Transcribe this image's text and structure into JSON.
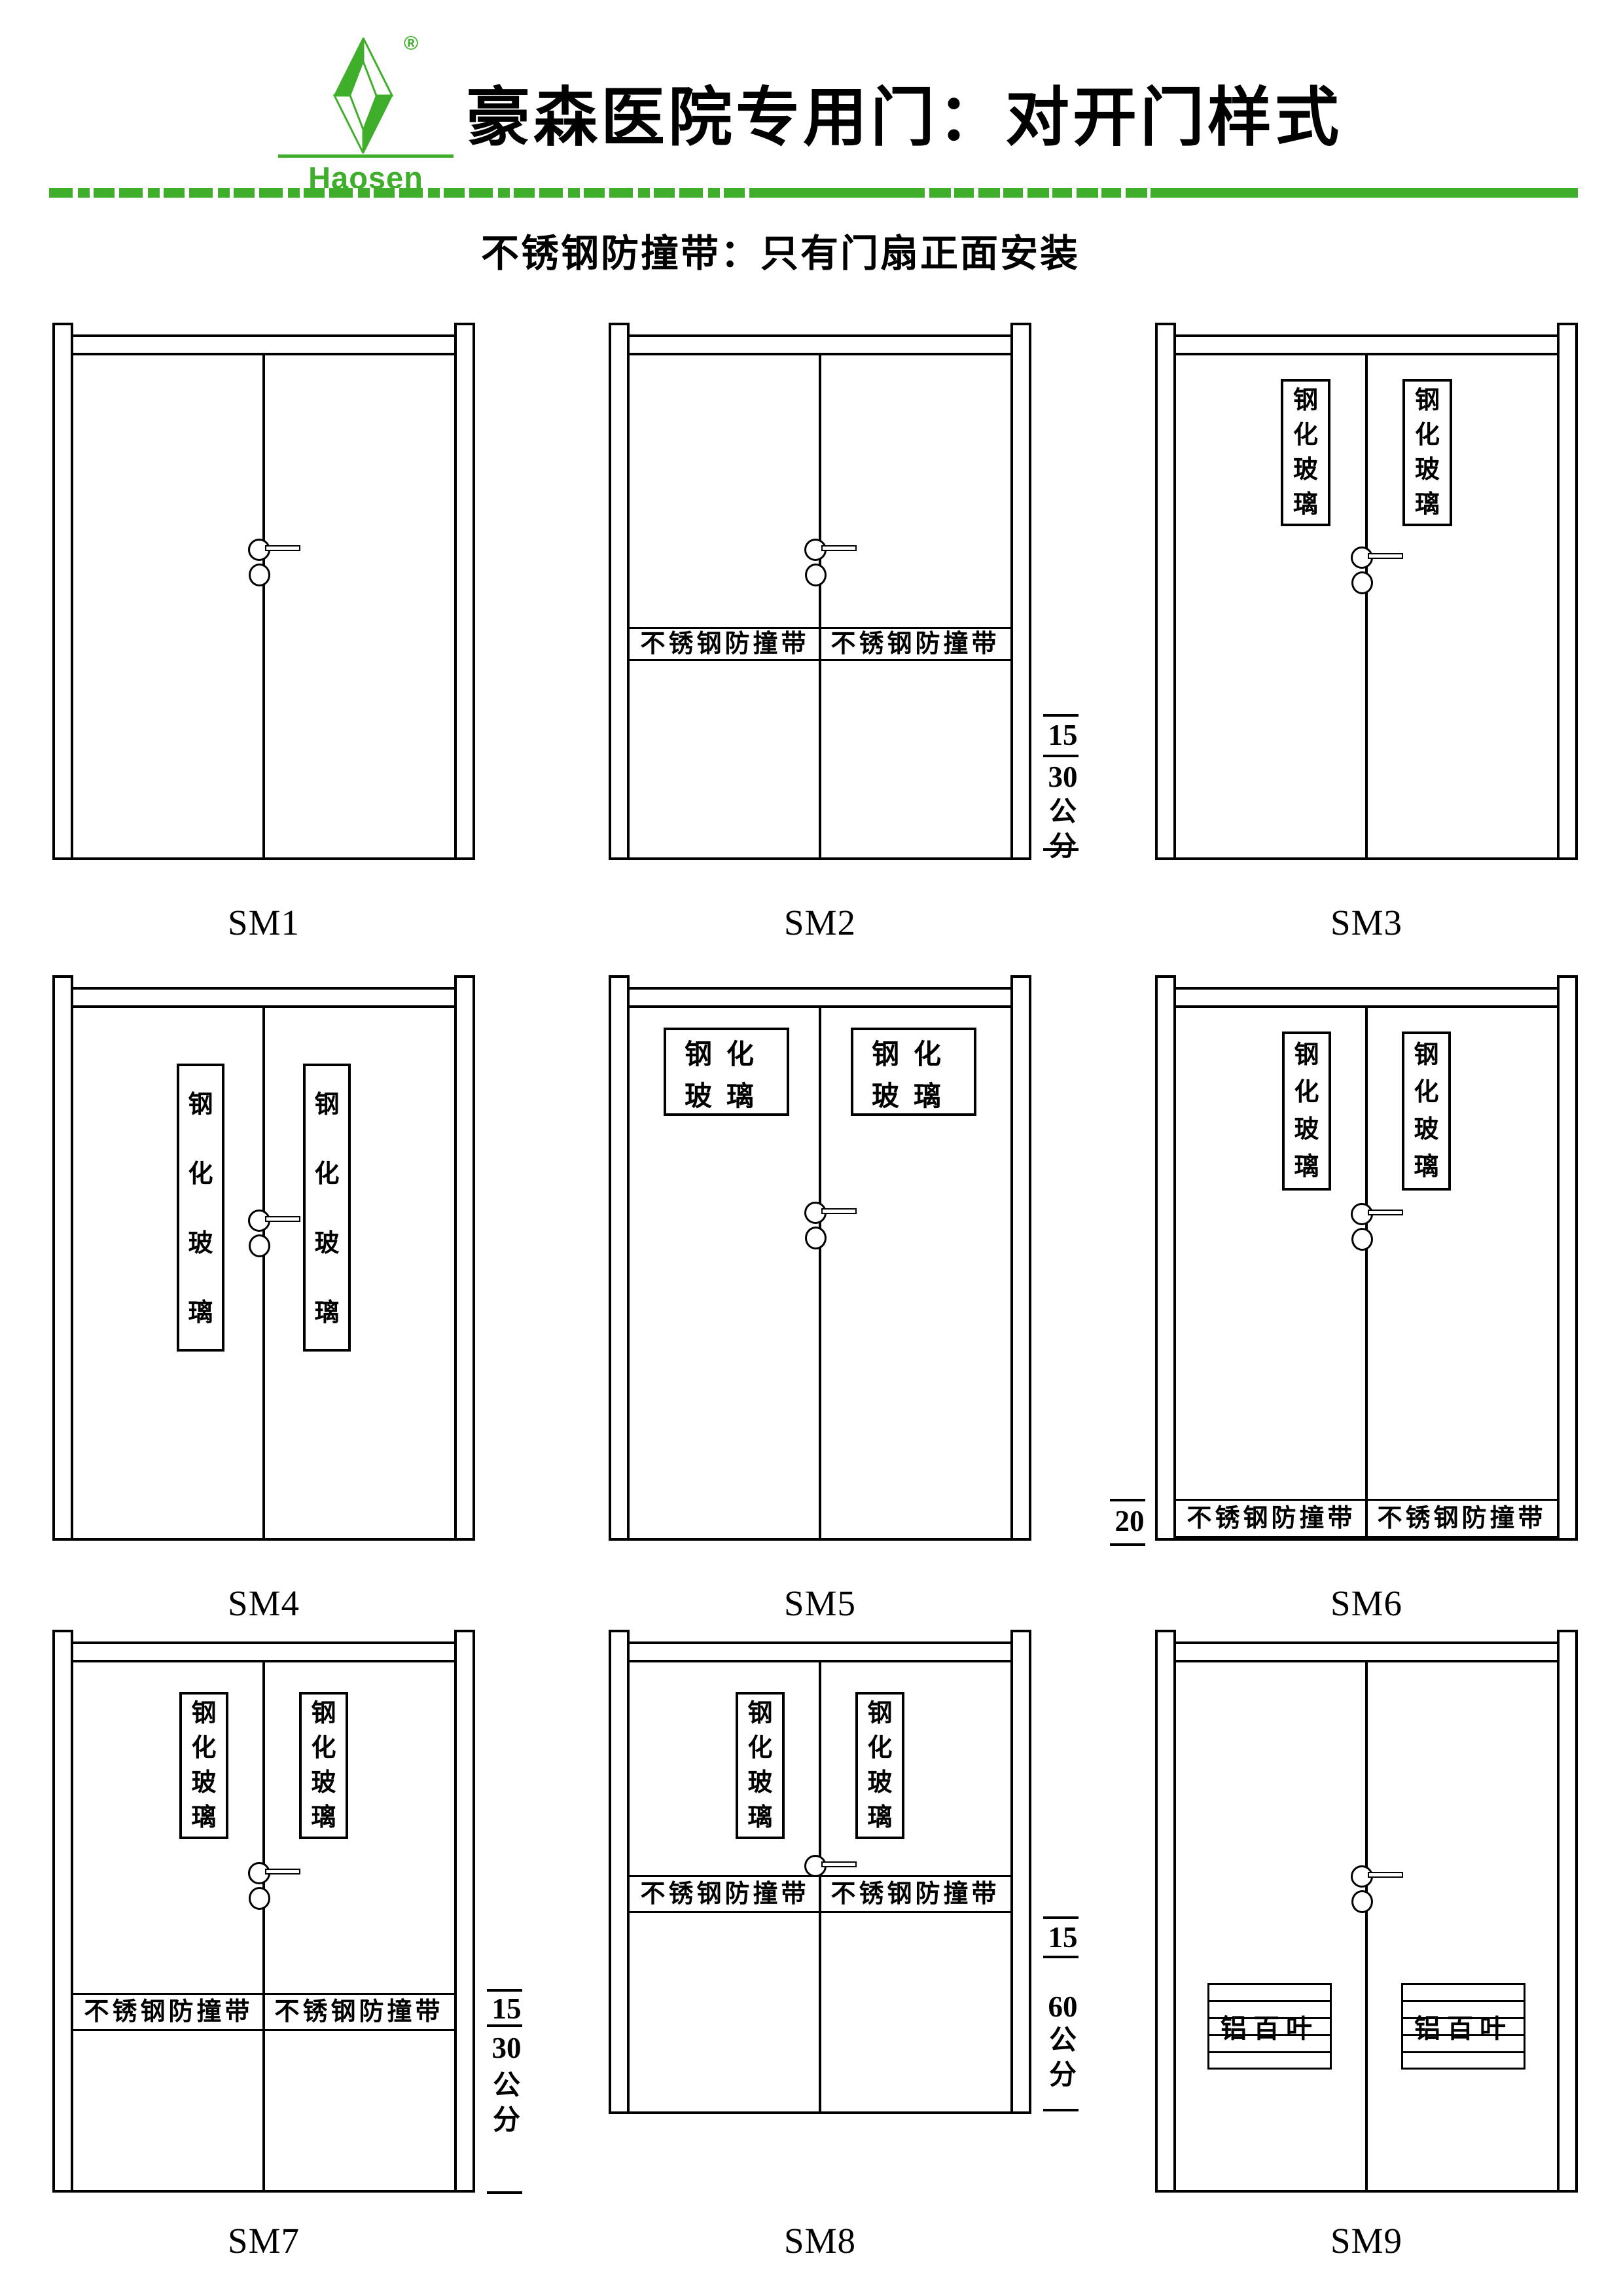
{
  "page": {
    "background": "#ffffff",
    "ink": "#000000",
    "accent_green": "#3fae2b"
  },
  "header": {
    "logo": {
      "brand": "Haosen",
      "registered_mark": "®"
    },
    "title": "豪森医院专用门：对开门样式",
    "subtitle": "不锈钢防撞带：只有门扇正面安装"
  },
  "strings": {
    "glass": "钢化玻璃",
    "strip": "不锈钢防撞带",
    "louver": "铝百叶"
  },
  "doors": [
    {
      "id": "SM1",
      "label": "SM1"
    },
    {
      "id": "SM2",
      "label": "SM2"
    },
    {
      "id": "SM3",
      "label": "SM3"
    },
    {
      "id": "SM4",
      "label": "SM4"
    },
    {
      "id": "SM5",
      "label": "SM5"
    },
    {
      "id": "SM6",
      "label": "SM6"
    },
    {
      "id": "SM7",
      "label": "SM7"
    },
    {
      "id": "SM8",
      "label": "SM8"
    },
    {
      "id": "SM9",
      "label": "SM9"
    }
  ],
  "dims": {
    "sm2": {
      "v1": "15",
      "v2": "30",
      "unit": "公分"
    },
    "sm6": {
      "v": "20"
    },
    "sm7": {
      "v1": "15",
      "v2": "30",
      "unit": "公分"
    },
    "sm8": {
      "v1": "15",
      "v2": "60",
      "unit": "公分"
    }
  }
}
